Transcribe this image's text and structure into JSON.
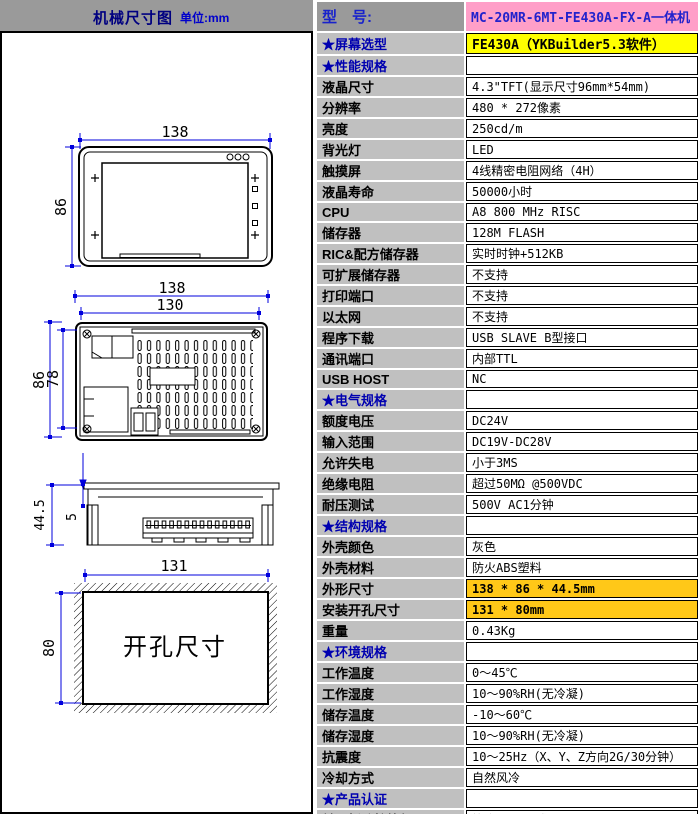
{
  "header": {
    "title": "机械尺寸图",
    "unit": "单位:mm"
  },
  "drawing": {
    "front": {
      "width": "138",
      "height": "86"
    },
    "rear": {
      "width": "138",
      "inner_width": "130",
      "height": "86",
      "inner_height": "78"
    },
    "side": {
      "depth": "44.5",
      "bezel": "5"
    },
    "cutout": {
      "width": "131",
      "height": "80",
      "label": "开孔尺寸"
    }
  },
  "colors": {
    "header_bg": "#9a9a9a",
    "label_bg": "#c0c0c0",
    "model_bg": "#ff9fc8",
    "model_text": "#2222cc",
    "screen_bg": "#ffff00",
    "dim_highlight_bg": "#ffc818",
    "section_text": "#0000b0",
    "dimension_line": "#0000dd"
  },
  "spec": {
    "rows": [
      {
        "label": "型　号:",
        "value": "MC-20MR-6MT-FE430A-FX-A一体机",
        "type": "model"
      },
      {
        "label": "★屏幕选型",
        "value": "FE430A（YKBuilder5.3软件）",
        "type": "screen"
      },
      {
        "label": "★性能规格",
        "value": "",
        "type": "section"
      },
      {
        "label": "液晶尺寸",
        "value": "4.3\"TFT(显示尺寸96mm*54mm)",
        "type": "normal"
      },
      {
        "label": "分辨率",
        "value": "480 * 272像素",
        "type": "normal"
      },
      {
        "label": "亮度",
        "value": "250cd/m",
        "type": "normal"
      },
      {
        "label": "背光灯",
        "value": "LED",
        "type": "normal"
      },
      {
        "label": "触摸屏",
        "value": "4线精密电阻网络（4H）",
        "type": "normal"
      },
      {
        "label": "液晶寿命",
        "value": "50000小时",
        "type": "normal"
      },
      {
        "label": "CPU",
        "value": "A8 800 MHz RISC",
        "type": "normal"
      },
      {
        "label": "储存器",
        "value": "128M FLASH",
        "type": "normal"
      },
      {
        "label": "RIC&配方储存器",
        "value": "实时时钟+512KB",
        "type": "normal"
      },
      {
        "label": "可扩展储存器",
        "value": "不支持",
        "type": "normal"
      },
      {
        "label": "打印端口",
        "value": "不支持",
        "type": "normal"
      },
      {
        "label": "以太网",
        "value": "不支持",
        "type": "normal"
      },
      {
        "label": "程序下载",
        "value": "USB SLAVE B型接口",
        "type": "normal"
      },
      {
        "label": "通讯端口",
        "value": "内部TTL",
        "type": "normal"
      },
      {
        "label": "USB HOST",
        "value": "NC",
        "type": "normal"
      },
      {
        "label": "★电气规格",
        "value": "",
        "type": "section"
      },
      {
        "label": "额度电压",
        "value": "DC24V",
        "type": "normal"
      },
      {
        "label": "输入范围",
        "value": "DC19V-DC28V",
        "type": "normal"
      },
      {
        "label": "允许失电",
        "value": "小于3MS",
        "type": "normal"
      },
      {
        "label": "绝缘电阻",
        "value": "超过50MΩ @500VDC",
        "type": "normal"
      },
      {
        "label": "耐压测试",
        "value": "500V AC1分钟",
        "type": "normal"
      },
      {
        "label": "★结构规格",
        "value": "",
        "type": "section"
      },
      {
        "label": "外壳颜色",
        "value": "灰色",
        "type": "normal"
      },
      {
        "label": "外壳材料",
        "value": "防火ABS塑料",
        "type": "normal"
      },
      {
        "label": "外形尺寸",
        "value": "138 * 86 * 44.5mm",
        "type": "dim"
      },
      {
        "label": "安装开孔尺寸",
        "value": "131 * 80mm",
        "type": "dim"
      },
      {
        "label": "重量",
        "value": "0.43Kg",
        "type": "normal"
      },
      {
        "label": "★环境规格",
        "value": "",
        "type": "section"
      },
      {
        "label": "工作温度",
        "value": "0～45℃",
        "type": "normal"
      },
      {
        "label": "工作湿度",
        "value": "10～90%RH(无冷凝)",
        "type": "normal"
      },
      {
        "label": "储存温度",
        "value": "-10～60℃",
        "type": "normal"
      },
      {
        "label": "储存湿度",
        "value": "10～90%RH(无冷凝)",
        "type": "normal"
      },
      {
        "label": "抗震度",
        "value": "10～25Hz（X、Y、Z方向2G/30分钟）",
        "type": "normal"
      },
      {
        "label": "冷却方式",
        "value": "自然风冷",
        "type": "normal"
      },
      {
        "label": "★产品认证",
        "value": "",
        "type": "section"
      },
      {
        "label": "前面板防护等级",
        "value": "符合IP65要求",
        "type": "normal"
      },
      {
        "label": "CE认证",
        "value": "通过CE认证（EN61000-6-2:200S）",
        "type": "ce"
      }
    ]
  }
}
